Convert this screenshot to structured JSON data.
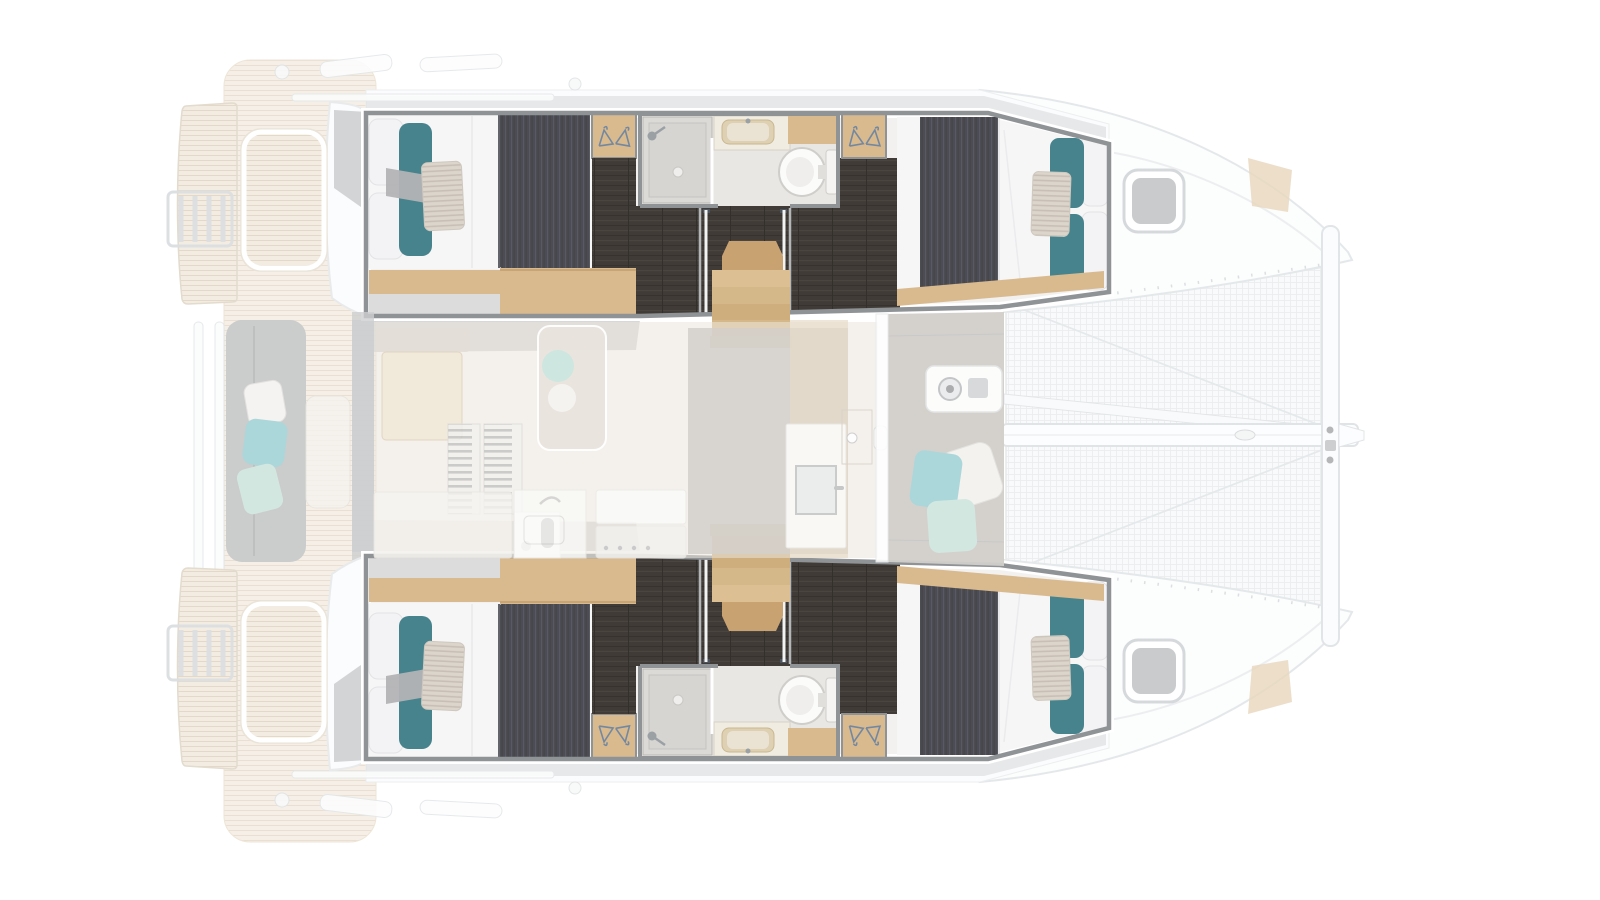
{
  "document": {
    "title": "Catamaran interior layout floor plan",
    "view": "top-down",
    "orientation": "bow facing right, stern on the left",
    "visible_text": "none (drawing contains no text labels)"
  },
  "palette": {
    "bg": "#ffffff",
    "ghost-line": "#e6e9ea",
    "ghost-fill": "#fcfcfd",
    "deck-gray": "#dadbdc",
    "teak-base": "#f3ece2",
    "teak-line": "#e4d9c7",
    "frame": "#8f9396",
    "floor-dark": "#403b37",
    "wood": "#d9ba8e",
    "wood-dark": "#c8a271",
    "mattress": "#f6f6f7",
    "duvet": "#4b4c51",
    "teal": "#47838c",
    "pillow-stripe": "#d9d2c9",
    "bench-gray": "#cbcccc",
    "aqua": "#abd7da",
    "mint": "#d3e7e1",
    "salon-ghost": "#ece6dd",
    "center-gray": "#d2cfca",
    "bath-floor": "#e9e7e3",
    "shower-gray": "#d6d5d2",
    "hatch-gray": "#c9cbcc",
    "tramp-line": "#e7eaec",
    "hanger-blue": "#7388a0"
  },
  "plan": {
    "hulls": [
      {
        "name": "port hull (top)",
        "rooms": [
          {
            "name": "aft double cabin",
            "features": [
              "double berth",
              "teal accent pillows",
              "striped pillow",
              "wardrobe with hangers",
              "wood shelf"
            ]
          },
          {
            "name": "head",
            "features": [
              "shower cubicle with shower head and drain",
              "washbasin vanity",
              "wood counter",
              "toilet"
            ]
          },
          {
            "name": "forward double cabin",
            "features": [
              "double berth",
              "teal accent pillows",
              "wardrobe with hangers",
              "deck hatch forward"
            ]
          }
        ],
        "circulation": [
          "companionway stairs with wood treads",
          "dark wood cabin sole"
        ]
      },
      {
        "name": "starboard hull (bottom)",
        "rooms": "mirror image of port hull: aft cabin, head, forward cabin"
      }
    ],
    "center_deck": {
      "aft": [
        "aft cockpit with teak sole",
        "bench seat with scatter cushions",
        "cockpit table",
        "dinghy davits",
        "swim platforms with boarding ladder",
        "transom steps"
      ],
      "saloon": [
        "ghosted saloon floor",
        "sofa and table",
        "chaise lounge with cushions",
        "louvered vents",
        "mast compression post",
        "galley counters with sink, faucet and stove",
        "nav console with locker door"
      ],
      "forward": [
        "forward cockpit with scatter cushions",
        "windlass console",
        "trampoline net",
        "anchor chain channel",
        "longitudinal beam",
        "forward crossbeam",
        "bowsprit",
        "bridle lines"
      ]
    }
  },
  "icons": [
    "hanger-icon",
    "shower-head-icon",
    "shower-drain-icon",
    "faucet-icon",
    "toilet-icon",
    "windlass-icon",
    "ladder-icon",
    "winch-icon"
  ]
}
